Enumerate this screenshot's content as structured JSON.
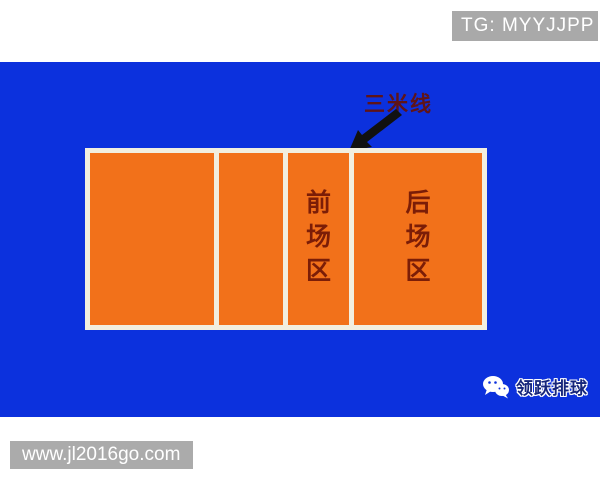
{
  "header": {
    "tg_badge_label": "TG: MYYJJPP"
  },
  "diagram": {
    "title_annotation": {
      "label": "三米线",
      "meaning": "three-meter line",
      "arrow": "black arrow pointing down-left to the three-meter line on the court"
    },
    "court": {
      "description": "volleyball court half-view with four sections divided by white lines",
      "zones": {
        "front": {
          "name": "前场区",
          "chars": [
            "前",
            "场",
            "区"
          ]
        },
        "back": {
          "name": "后场区",
          "chars": [
            "后",
            "场",
            "区"
          ]
        }
      }
    }
  },
  "footer": {
    "logo": {
      "icon": "wechat-icon",
      "text": "领跃排球"
    },
    "watermark": "www.jl2016go.com"
  },
  "colors": {
    "background_blue": "#0c31dd",
    "court_orange": "#f2711a",
    "court_line_white": "#f2efe0",
    "zone_label_red": "#7b1d07",
    "annotation_dark_red": "#5f1418",
    "badge_gray": "#a9a9a9",
    "arrow_black": "#111111",
    "logo_navy": "#16267c",
    "badge_text_white": "#ffffff"
  }
}
